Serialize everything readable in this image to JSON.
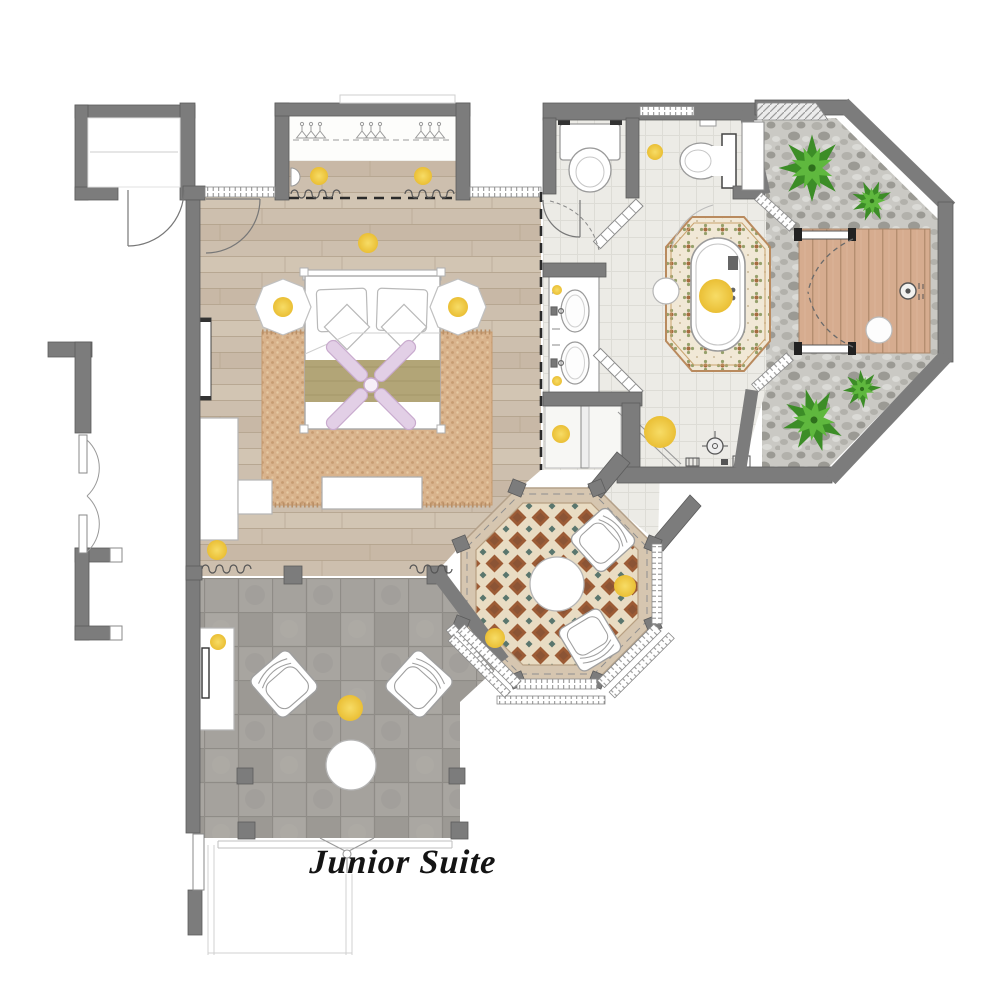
{
  "title": {
    "plan_label": "Junior Suite"
  },
  "colors": {
    "paper": "#ffffff",
    "ink": "#141414",
    "wall": "#7c7c7c",
    "wall-edge": "#5c5c5c",
    "wood": "#cdbfae",
    "wood-line": "#b2a18b",
    "wood-light": "#d6c9b8",
    "wood-dark": "#c3b29d",
    "rug": "#d9b38c",
    "rug-dot": "#c3966c",
    "rug-light": "#e8cfa9",
    "bath-floor": "#ecebe6",
    "bath-grid": "#dddcd6",
    "cream": "#e9dcc3",
    "brown": "#9c5b35",
    "brown2": "#7d4f35",
    "teal": "#5a766d",
    "plat-cream": "#f1e8d6",
    "plat-olive": "#96a06b",
    "plat-brown": "#a66b3f",
    "pebble": "#cac9c4",
    "pebble1": "#b2b1ab",
    "pebble2": "#9b9a94",
    "pebble3": "#dbdbd7",
    "deck": "#d6ac8f",
    "deck-line": "#b58e70",
    "terrace": "#a5a29d",
    "terrace-grout": "#8f8c87",
    "terrace-a": "#aaa7a2",
    "terrace-b": "#9c9994",
    "yellow": "#f0cc49",
    "yellow-deep": "#eabf35",
    "plant-dark": "#3c8d27",
    "plant-light": "#5fb83e",
    "plant-core": "#2e6f1c",
    "lavender": "#e2cfe6",
    "lavender-edge": "#c9abce",
    "runner": "#b2a577",
    "runner-line": "#9c8f62",
    "line": "#9f9f9f",
    "dash": "#2a2a2a",
    "curtain": "#6b6b6b",
    "glass": "#999999"
  }
}
